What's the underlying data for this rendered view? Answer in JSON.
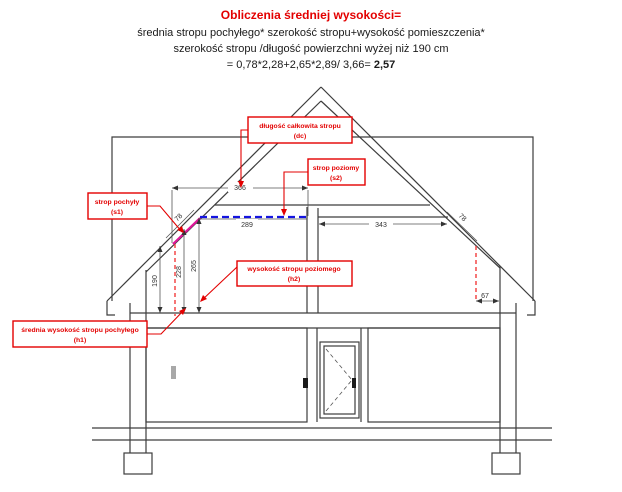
{
  "header": {
    "title": "Obliczenia średniej wysokości=",
    "formula_line1": "średnia stropu pochyłego* szerokość stropu+wysokość pomieszczenia*",
    "formula_line2": "szerokość stropu /długość powierzchni wyżej niż 190 cm",
    "formula_line3_prefix": "= 0,78*2,28+2,65*2,89/ 3,66= ",
    "formula_result": "2,57"
  },
  "labels": {
    "dc": {
      "line1": "długość całkowita stropu",
      "line2": "(dc)"
    },
    "s2": {
      "line1": "strop poziomy",
      "line2": "(s2)"
    },
    "s1": {
      "line1": "strop pochyły",
      "line2": "(s1)"
    },
    "h2": {
      "line1": "wysokość stropu poziomego",
      "line2": "(h2)"
    },
    "h1": {
      "line1": "średnia wysokość stropu pochyłego",
      "line2": "(h1)"
    }
  },
  "dimensions": {
    "total_ceiling_length": "366",
    "sloped_width_left": "78",
    "horizontal_ceiling_width": "289",
    "right_room_width": "343",
    "sloped_width_right": "78",
    "height_190_line": "190",
    "avg_sloped_ceiling_height": "228",
    "horizontal_ceiling_height": "265",
    "right_offset": "67"
  },
  "colors": {
    "annotation_red": "#e30000",
    "sloped_highlight_magenta": "#e0169a",
    "horizontal_highlight_blue": "#1414e0",
    "dashed_reference_red": "#f23b3b",
    "drawing_gray": "#3d3d3d"
  }
}
